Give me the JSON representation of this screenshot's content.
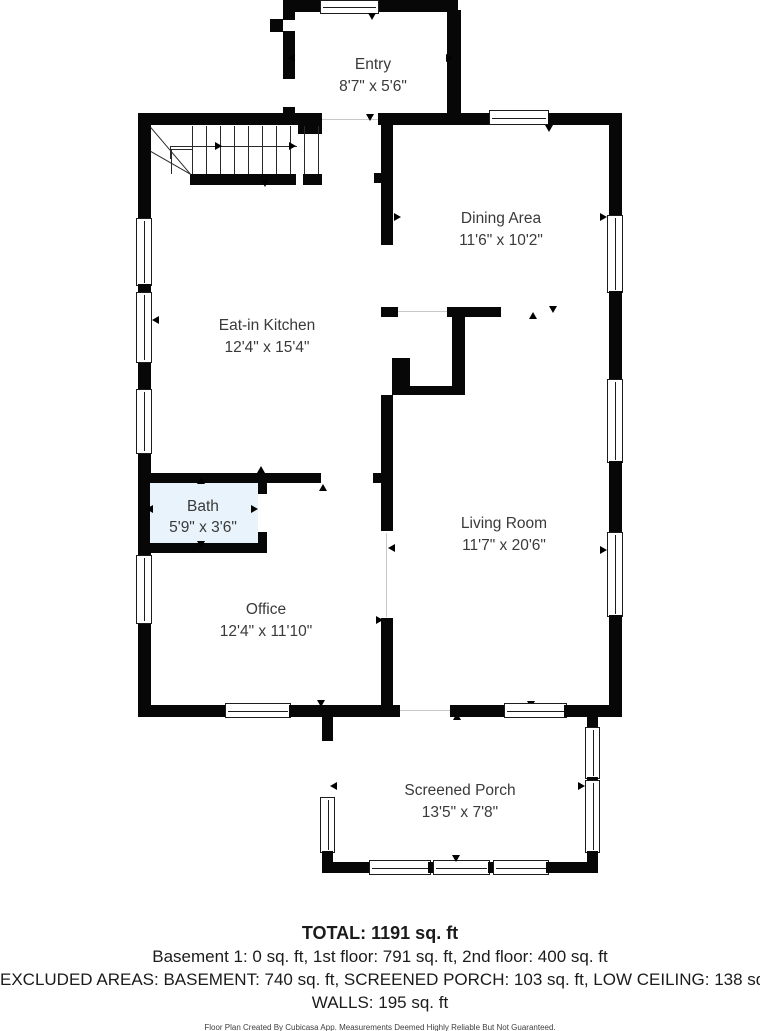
{
  "rooms": [
    {
      "id": "entry",
      "name": "Entry",
      "dimensions": "8'7\" x 5'6\""
    },
    {
      "id": "dining",
      "name": "Dining Area",
      "dimensions": "11'6\" x 10'2\""
    },
    {
      "id": "kitchen",
      "name": "Eat-in Kitchen",
      "dimensions": "12'4\" x 15'4\""
    },
    {
      "id": "bath",
      "name": "Bath",
      "dimensions": "5'9\" x 3'6\""
    },
    {
      "id": "living",
      "name": "Living Room",
      "dimensions": "11'7\" x 20'6\""
    },
    {
      "id": "office",
      "name": "Office",
      "dimensions": "12'4\" x 11'10\""
    },
    {
      "id": "porch",
      "name": "Screened Porch",
      "dimensions": "13'5\" x 7'8\""
    }
  ],
  "summary": {
    "total": "TOTAL: 1191 sq. ft",
    "floors_line": "Basement 1: 0 sq. ft, 1st floor: 791 sq. ft, 2nd floor: 400 sq. ft",
    "excluded_line": "EXCLUDED AREAS: BASEMENT: 740 sq. ft, SCREENED PORCH: 103 sq. ft, LOW CEILING: 138 sq. ft,",
    "walls_line": "WALLS: 195 sq. ft",
    "disclaimer": "Floor Plan Created By Cubicasa App. Measurements Deemed Highly Reliable But Not Guaranteed."
  },
  "colors": {
    "wall": "#070707",
    "bath_fill": "#E8F3FC",
    "label_text": "#3A3A3A"
  }
}
